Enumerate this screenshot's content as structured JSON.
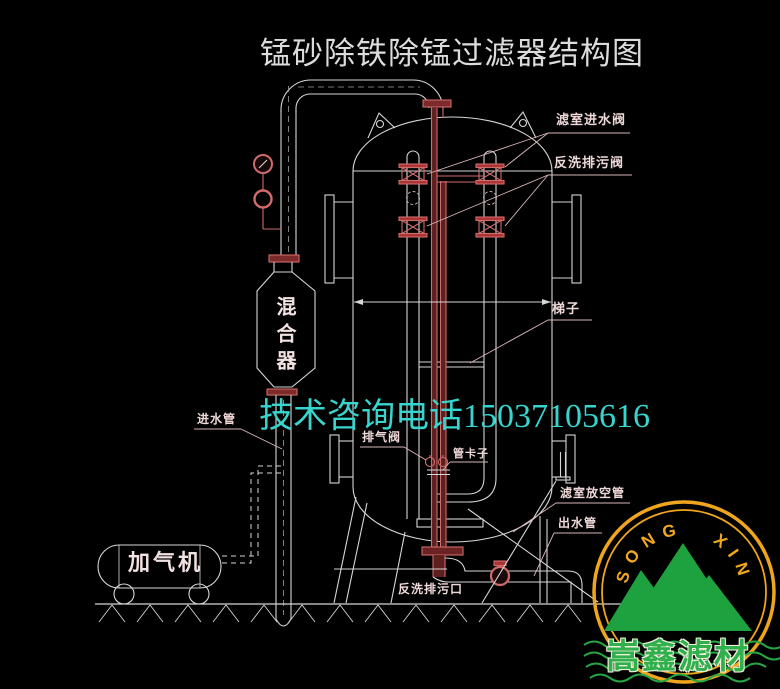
{
  "title": "锰砂除铁除锰过滤器结构图",
  "watermark": "技术咨询电话15037105616",
  "equipment": {
    "mixer": "混合器",
    "aerator": "加气机"
  },
  "labels": {
    "filter_chamber_inlet_valve": "滤室进水阀",
    "backwash_drain_valve": "反洗排污阀",
    "ladder": "梯子",
    "inlet_pipe": "进水管",
    "exhaust_valve": "排气阀",
    "pipe_clamp": "管卡子",
    "filter_chamber_vent_pipe": "滤室放空管",
    "outlet_pipe": "出水管",
    "backwash_drain_outlet": "反洗排污口"
  },
  "logo": {
    "arc_text": "SONG XIN",
    "company": "嵩鑫滤材"
  },
  "colors": {
    "background": "#000000",
    "drawing_line": "#d6d6d6",
    "pipe_red": "#cf6b6b",
    "label_pink": "#eed8d8",
    "watermark_cyan": "#38d5cf",
    "logo_ring_yellow": "#efa51d",
    "logo_green": "#1ea23f"
  }
}
